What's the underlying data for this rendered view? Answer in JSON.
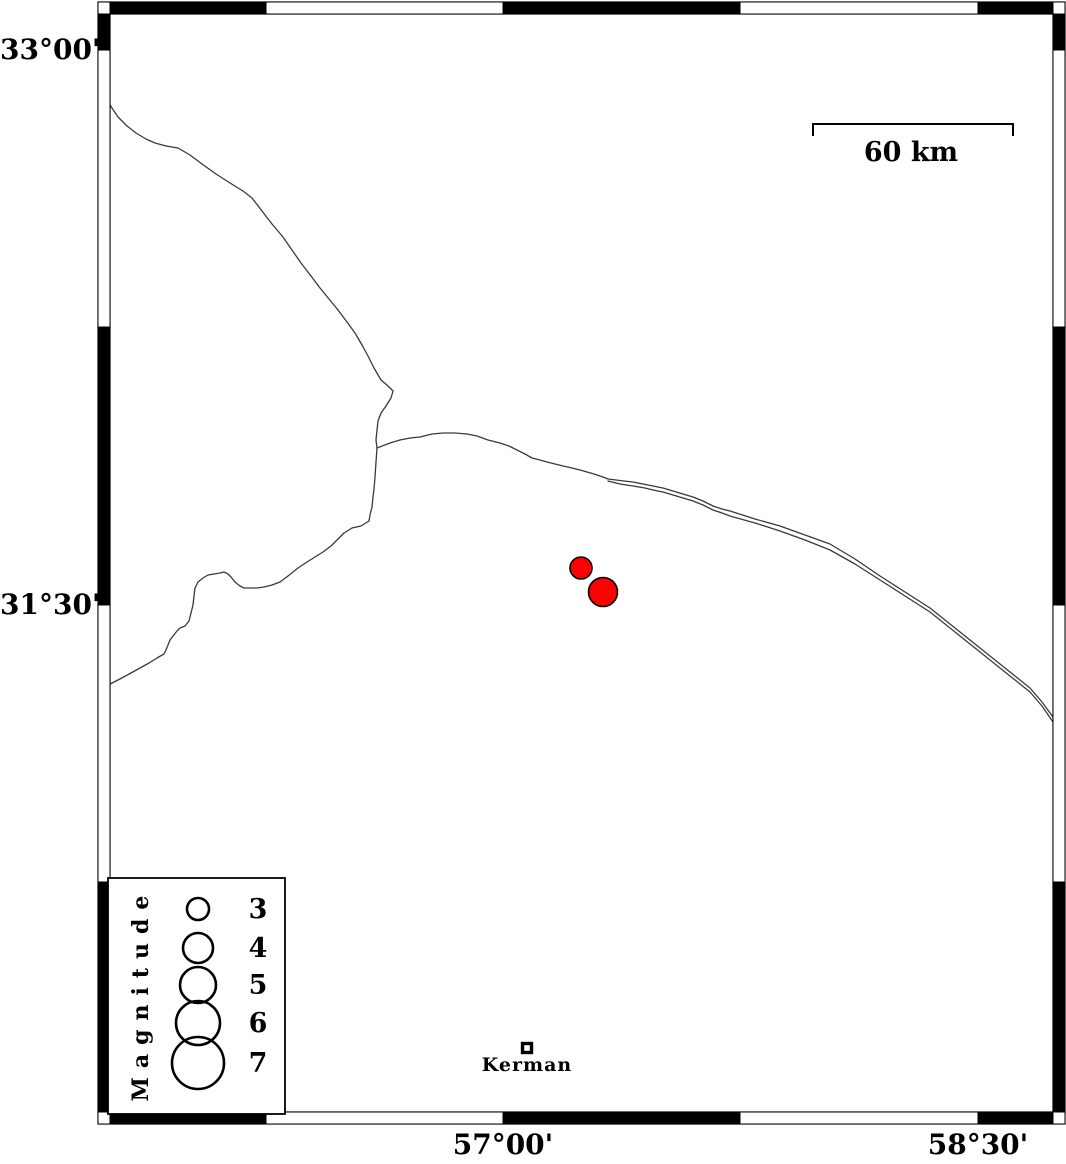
{
  "colors": {
    "background": "#ffffff",
    "frame": "#000000",
    "boundary_line": "#3a3a3a",
    "earthquake_fill": "#ff0000",
    "earthquake_stroke": "#000000"
  },
  "axes": {
    "lat_labels": [
      {
        "text": "33°00'",
        "y": 50
      },
      {
        "text": "31°30'",
        "y": 605
      }
    ],
    "lon_labels": [
      {
        "text": "57°00'",
        "x": 503
      },
      {
        "text": "58°30'",
        "x": 978
      }
    ]
  },
  "frame": {
    "outer": {
      "x": 98,
      "y": 2,
      "w": 967,
      "h": 1122
    },
    "band": 12,
    "x_bounds": [
      110,
      266,
      503,
      740,
      978,
      1053
    ],
    "y_bounds": [
      14,
      50,
      327,
      605,
      882,
      1112
    ]
  },
  "scalebar": {
    "label": "60 km",
    "x1": 813,
    "x2": 1013,
    "y": 124,
    "tick": 12
  },
  "legend": {
    "title": "Magnitude",
    "box": {
      "x": 108,
      "y": 878,
      "w": 177,
      "h": 236
    },
    "circle_x": 198,
    "value_x": 258,
    "entries": [
      {
        "value": "3",
        "y": 909,
        "r": 11
      },
      {
        "value": "4",
        "y": 948,
        "r": 15
      },
      {
        "value": "5",
        "y": 985,
        "r": 18
      },
      {
        "value": "6",
        "y": 1023,
        "r": 22
      },
      {
        "value": "7",
        "y": 1063,
        "r": 26
      }
    ]
  },
  "city": {
    "name": "Kerman",
    "x": 527,
    "y": 1048,
    "marker_size": 9
  },
  "earthquakes": [
    {
      "x": 581,
      "y": 568,
      "r": 11
    },
    {
      "x": 603,
      "y": 592,
      "r": 14.5
    }
  ],
  "map_lines": {
    "boundary_nw": [
      [
        110,
        105
      ],
      [
        118,
        117
      ],
      [
        127,
        126
      ],
      [
        136,
        133
      ],
      [
        146,
        139
      ],
      [
        155,
        143
      ],
      [
        166,
        146
      ],
      [
        178,
        148
      ],
      [
        190,
        155
      ],
      [
        202,
        164
      ],
      [
        216,
        174
      ],
      [
        230,
        183
      ],
      [
        243,
        191
      ],
      [
        252,
        198
      ],
      [
        262,
        211
      ],
      [
        272,
        224
      ],
      [
        283,
        237
      ],
      [
        292,
        250
      ],
      [
        301,
        263
      ],
      [
        311,
        276
      ],
      [
        320,
        288
      ],
      [
        329,
        299
      ],
      [
        338,
        310
      ],
      [
        347,
        322
      ],
      [
        355,
        333
      ],
      [
        362,
        345
      ],
      [
        368,
        356
      ],
      [
        374,
        368
      ],
      [
        381,
        380
      ],
      [
        388,
        386
      ],
      [
        393,
        391
      ],
      [
        391,
        398
      ],
      [
        386,
        406
      ],
      [
        381,
        413
      ],
      [
        378,
        421
      ],
      [
        377,
        430
      ],
      [
        376,
        440
      ],
      [
        377,
        448
      ],
      [
        376,
        462
      ],
      [
        375,
        477
      ],
      [
        374,
        489
      ],
      [
        373,
        497
      ],
      [
        372,
        507
      ],
      [
        370,
        515
      ],
      [
        369,
        521
      ],
      [
        361,
        526
      ],
      [
        352,
        528
      ],
      [
        344,
        533
      ],
      [
        337,
        540
      ],
      [
        331,
        546
      ],
      [
        323,
        552
      ],
      [
        315,
        557
      ],
      [
        307,
        562
      ],
      [
        298,
        568
      ],
      [
        288,
        576
      ],
      [
        280,
        582
      ],
      [
        272,
        585
      ],
      [
        264,
        587
      ],
      [
        257,
        588
      ],
      [
        250,
        588
      ],
      [
        244,
        588
      ],
      [
        240,
        586
      ],
      [
        235,
        582
      ],
      [
        231,
        577
      ],
      [
        228,
        574
      ],
      [
        224,
        572
      ],
      [
        220,
        573
      ],
      [
        214,
        574
      ],
      [
        208,
        575
      ],
      [
        203,
        578
      ],
      [
        198,
        582
      ],
      [
        195,
        588
      ],
      [
        194,
        596
      ],
      [
        193,
        605
      ],
      [
        191,
        613
      ],
      [
        189,
        621
      ],
      [
        185,
        626
      ],
      [
        180,
        628
      ],
      [
        177,
        631
      ],
      [
        173,
        636
      ],
      [
        170,
        640
      ],
      [
        168,
        645
      ],
      [
        166,
        650
      ],
      [
        164,
        654
      ],
      [
        157,
        658
      ],
      [
        149,
        663
      ],
      [
        140,
        668
      ],
      [
        131,
        673
      ],
      [
        120,
        679
      ],
      [
        108,
        685
      ]
    ],
    "boundary_east_main": [
      [
        377,
        448
      ],
      [
        390,
        443
      ],
      [
        400,
        440
      ],
      [
        410,
        438
      ],
      [
        420,
        437
      ],
      [
        432,
        434
      ],
      [
        443,
        433
      ],
      [
        455,
        433
      ],
      [
        467,
        434
      ],
      [
        477,
        436
      ],
      [
        488,
        440
      ],
      [
        500,
        443
      ],
      [
        509,
        446
      ],
      [
        517,
        450
      ],
      [
        525,
        454
      ],
      [
        532,
        458
      ],
      [
        540,
        460
      ],
      [
        547,
        462
      ],
      [
        555,
        464
      ],
      [
        563,
        466
      ],
      [
        572,
        468
      ],
      [
        580,
        470
      ],
      [
        587,
        472
      ],
      [
        594,
        474
      ],
      [
        603,
        477
      ],
      [
        608,
        479
      ],
      [
        616,
        480
      ],
      [
        624,
        481
      ],
      [
        633,
        482
      ],
      [
        643,
        484
      ],
      [
        653,
        486
      ],
      [
        663,
        488
      ],
      [
        673,
        491
      ],
      [
        683,
        494
      ],
      [
        693,
        497
      ],
      [
        703,
        501
      ],
      [
        713,
        506
      ],
      [
        722,
        509
      ],
      [
        730,
        511
      ],
      [
        755,
        519
      ],
      [
        780,
        526
      ],
      [
        805,
        535
      ],
      [
        830,
        544
      ],
      [
        855,
        559
      ],
      [
        880,
        576
      ],
      [
        905,
        592
      ],
      [
        930,
        608
      ],
      [
        955,
        628
      ],
      [
        980,
        648
      ],
      [
        1005,
        668
      ],
      [
        1030,
        688
      ],
      [
        1042,
        702
      ],
      [
        1053,
        717
      ]
    ],
    "boundary_east_south": [
      [
        608,
        481
      ],
      [
        620,
        484
      ],
      [
        633,
        486
      ],
      [
        645,
        488
      ],
      [
        653,
        490
      ],
      [
        663,
        492
      ],
      [
        673,
        495
      ],
      [
        683,
        498
      ],
      [
        693,
        501
      ],
      [
        703,
        505
      ],
      [
        713,
        510
      ],
      [
        722,
        513
      ],
      [
        730,
        516
      ],
      [
        755,
        523
      ],
      [
        780,
        531
      ],
      [
        805,
        540
      ],
      [
        830,
        550
      ],
      [
        855,
        564
      ],
      [
        880,
        580
      ],
      [
        905,
        596
      ],
      [
        930,
        612
      ],
      [
        955,
        632
      ],
      [
        980,
        652
      ],
      [
        1005,
        672
      ],
      [
        1030,
        692
      ],
      [
        1042,
        706
      ],
      [
        1053,
        722
      ]
    ]
  }
}
